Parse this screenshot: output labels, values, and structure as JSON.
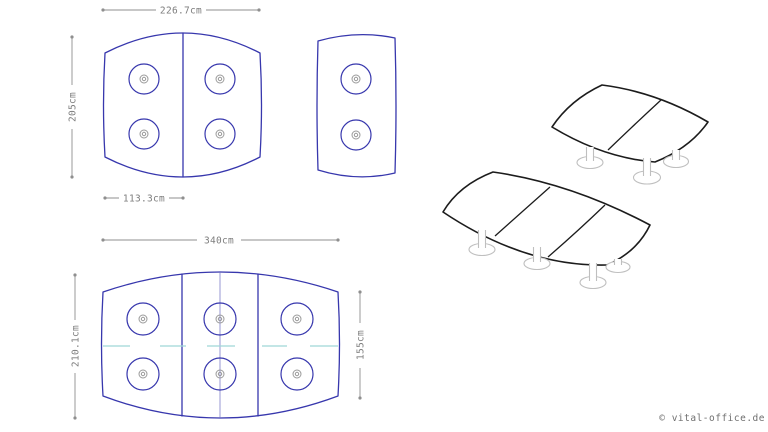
{
  "colors": {
    "background": "#ffffff",
    "plan-outline": "#3737ad",
    "center-mark": "#9a9a9a",
    "dimension": "#8f8f8f",
    "dimension-text": "#7d7d7d",
    "centerline-cyan": "#9fd8d8",
    "centerline-blue": "#6b6bc0",
    "render-outline": "#1c1c1c",
    "leg-gray": "#bfbfbf",
    "watermark-gray": "#6f6f6f"
  },
  "plans": {
    "two_segment": {
      "width_label": "226.7cm",
      "height_label": "205cm",
      "segment_width_label": "113.3cm"
    },
    "three_segment": {
      "width_label": "340cm",
      "height_label": "210.1cm",
      "side_height_label": "155cm"
    }
  },
  "watermark": "© vital-office.de"
}
